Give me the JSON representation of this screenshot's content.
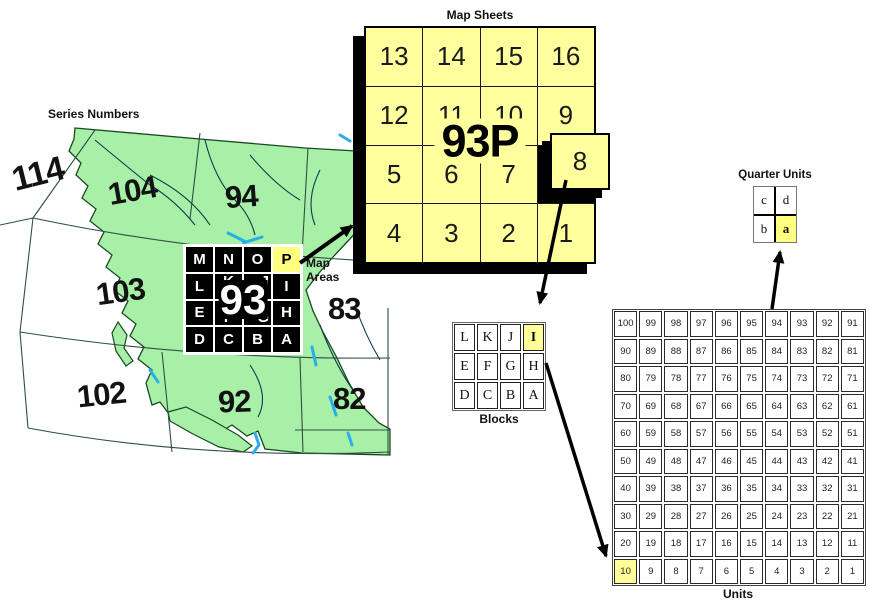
{
  "labels": {
    "series_numbers": "Series Numbers",
    "map_sheets": "Map Sheets",
    "map_areas_line1": "Map",
    "map_areas_line2": "Areas",
    "blocks": "Blocks",
    "units": "Units",
    "quarter_units": "Quarter Units"
  },
  "colors": {
    "highlight_yellow": "#FFFF99",
    "sheet_yellow": "#FFFF9E",
    "land_green": "#A8F0A8",
    "water_blue": "#2BAEE8",
    "grid_black": "#000000"
  },
  "map": {
    "series_numbers": [
      "114",
      "104",
      "94",
      "103",
      "83",
      "102",
      "92",
      "82"
    ],
    "map_areas": {
      "center_label": "93",
      "cells": [
        "M",
        "N",
        "O",
        "P",
        "L",
        "K",
        "J",
        "I",
        "E",
        "F",
        "G",
        "H",
        "D",
        "C",
        "B",
        "A"
      ],
      "highlighted_cell": "P"
    }
  },
  "map_sheets": {
    "center_label": "93P",
    "popped_cell": "8",
    "cells": [
      "13",
      "14",
      "15",
      "16",
      "12",
      "11",
      "10",
      "9",
      "5",
      "6",
      "7",
      "",
      "4",
      "3",
      "2",
      "1"
    ]
  },
  "blocks": {
    "cells": [
      "L",
      "K",
      "J",
      "I",
      "E",
      "F",
      "G",
      "H",
      "D",
      "C",
      "B",
      "A"
    ],
    "highlighted_cell": "I"
  },
  "units": {
    "highlighted_cell": 10,
    "cells": [
      100,
      99,
      98,
      97,
      96,
      95,
      94,
      93,
      92,
      91,
      90,
      89,
      88,
      87,
      86,
      85,
      84,
      83,
      82,
      81,
      80,
      79,
      78,
      77,
      76,
      75,
      74,
      73,
      72,
      71,
      70,
      69,
      68,
      67,
      66,
      65,
      64,
      63,
      62,
      61,
      60,
      59,
      58,
      57,
      56,
      55,
      54,
      53,
      52,
      51,
      50,
      49,
      48,
      47,
      46,
      45,
      44,
      43,
      42,
      41,
      40,
      39,
      38,
      37,
      36,
      35,
      34,
      33,
      32,
      31,
      30,
      29,
      28,
      27,
      26,
      25,
      24,
      23,
      22,
      21,
      20,
      19,
      18,
      17,
      16,
      15,
      14,
      13,
      12,
      11,
      10,
      9,
      8,
      7,
      6,
      5,
      4,
      3,
      2,
      1
    ]
  },
  "quarter_units": {
    "cells": [
      "c",
      "d",
      "b",
      "a"
    ],
    "highlighted_cell": "a"
  }
}
